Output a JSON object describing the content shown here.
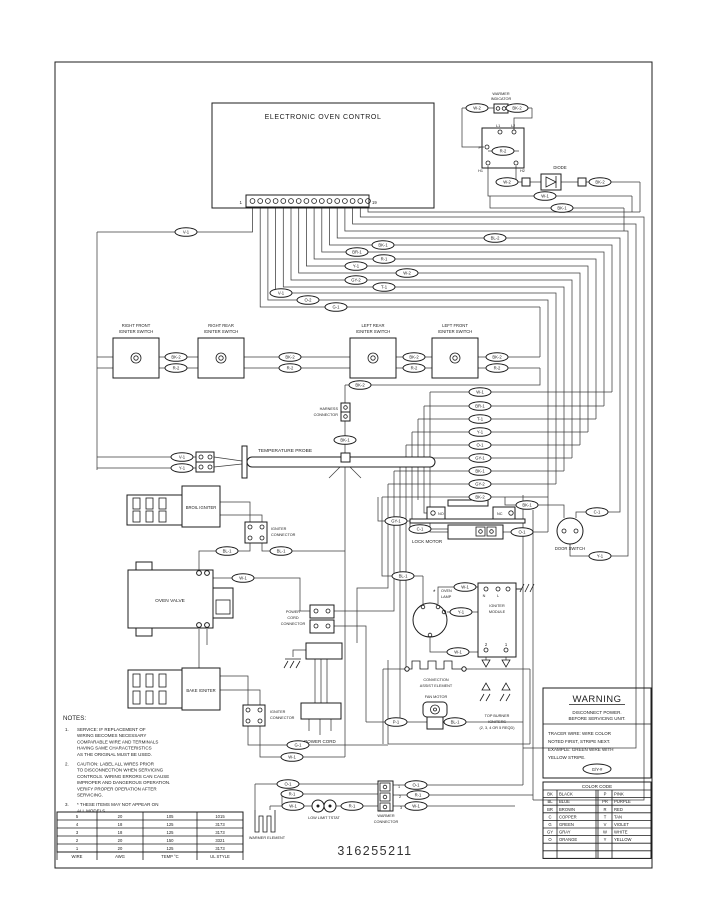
{
  "part_number": "316255211",
  "eoc": {
    "title": "ELECTRONIC OVEN CONTROL",
    "first_terminal": "1",
    "last_terminal": "19"
  },
  "warmer_indicator": {
    "line1": "WARMER",
    "line2": "INDICATOR",
    "relay": {
      "p": "P",
      "l1": "L1",
      "l2": "L2",
      "h1": "H1",
      "h2": "H2"
    },
    "diode": "DIODE"
  },
  "switches": [
    {
      "line1": "RIGHT FRONT",
      "line2": "IGNITER SWITCH"
    },
    {
      "line1": "RIGHT REAR",
      "line2": "IGNITER SWITCH"
    },
    {
      "line1": "LEFT REAR",
      "line2": "IGNITER SWITCH"
    },
    {
      "line1": "LEFT FRONT",
      "line2": "IGNITER SWITCH"
    }
  ],
  "components": {
    "harness_connector1": "HARNESS",
    "harness_connector2": "CONNECTOR",
    "temperature_probe": "TEMPERATURE PROBE",
    "broil_igniter": "BROIL IGNITER",
    "igniter_connector1": "IGNITER",
    "igniter_connector2": "CONNECTOR",
    "oven_valve": "OVEN VALVE",
    "bake_igniter": "BAKE IGNITER",
    "power_cord_connector1": "POWER",
    "power_cord_connector2": "CORD",
    "power_cord_connector3": "CONNECTOR",
    "power_cord": "POWER CORD",
    "lock_motor": "LOCK MOTOR",
    "lock_no": "NO",
    "lock_nc": "NC",
    "door_switch": "DOOR SWITCH",
    "oven_lamp_star": "*",
    "oven_lamp1": "OVEN",
    "oven_lamp2": "LAMP",
    "igniter_module1": "IGNITER",
    "igniter_module2": "MODULE",
    "module_n": "N",
    "module_l": "L",
    "module_2": "2",
    "module_1": "1",
    "convection1": "CONVECTION",
    "convection2": "ASSIST ELEMENT",
    "fan_motor": "FAN MOTOR",
    "top_burner1": "TOP BURNER",
    "top_burner2": "IGNITERS",
    "top_burner3": "(2, 3, 4 OR 5 REQD)",
    "warmer_element": "WARMER ELEMENT",
    "low_limit": "LOW LIMIT TSTAT",
    "warmer_connector1": "WARMER",
    "warmer_connector2": "CONNECTOR",
    "warmer_pins": [
      "1",
      "2",
      "3"
    ]
  },
  "notes": {
    "title": "NOTES:",
    "items": [
      {
        "num": "1.",
        "lines": [
          "SERVICE:  IF REPLACEMENT OF",
          "WIRING BECOMES NECESSARY",
          "COMPARABLE WIRE AND TERMINALS",
          "HAVING SAME CHARACTERISTICS",
          "AS THE ORIGINAL MUST BE USED."
        ]
      },
      {
        "num": "2.",
        "lines": [
          "CAUTION:  LABEL ALL WIRES PRIOR",
          "TO DISCONNECTION WHEN SERVICING",
          "CONTROLS.  WIRING ERRORS CAN CAUSE",
          "IMPROPER AND DANGEROUS OPERATION.",
          "VERIFY PROPER OPERATION AFTER",
          "SERVICING."
        ]
      },
      {
        "num": "3.",
        "lines": [
          "* THESE ITEMS MAY NOT APPEAR ON",
          "ALL MODELS."
        ]
      }
    ]
  },
  "wire_table": {
    "rows": [
      [
        "5",
        "20",
        "105",
        "1015"
      ],
      [
        "4",
        "18",
        "125",
        "3173"
      ],
      [
        "3",
        "18",
        "125",
        "3173"
      ],
      [
        "2",
        "20",
        "150",
        "3321"
      ],
      [
        "1",
        "20",
        "125",
        "3173"
      ]
    ],
    "footer": [
      "WIRE",
      "AWG",
      "TEMP °C",
      "UL STYLE"
    ]
  },
  "warning": {
    "title": "WARNING",
    "lines": [
      "DISCONNECT POWER.",
      "BEFORE SERVICING UNIT."
    ],
    "tracer_lines": [
      "TRACER WIRE:  WIRE COLOR",
      "NOTED FIRST, STRIPE NEXT.",
      "EXAMPLE:  GREEN WIRE WITH",
      "YELLOW STRIPE."
    ],
    "example_label": "G/Y-#"
  },
  "color_code": {
    "title": "COLOR CODE",
    "rows": [
      [
        "BK",
        "BLACK",
        "P",
        "PINK"
      ],
      [
        "BL",
        "BLUE",
        "PR",
        "PURPLE"
      ],
      [
        "BR",
        "BROWN",
        "R",
        "RED"
      ],
      [
        "C",
        "COPPER",
        "T",
        "TAN"
      ],
      [
        "G",
        "GREEN",
        "V",
        "VIOLET"
      ],
      [
        "GY",
        "GRAY",
        "W",
        "WHITE"
      ],
      [
        "O",
        "ORANGE",
        "Y",
        "YELLOW"
      ]
    ],
    "empty_rows": 2
  },
  "wire_labels": [
    [
      477,
      108,
      "W-2"
    ],
    [
      517,
      108,
      "BK-2"
    ],
    [
      503,
      151,
      "R-2"
    ],
    [
      507,
      182,
      "W-2"
    ],
    [
      600,
      182,
      "BK-2"
    ],
    [
      545,
      196,
      "W-1"
    ],
    [
      562,
      208,
      "BK-1"
    ],
    [
      186,
      232,
      "V-1"
    ],
    [
      336,
      307,
      "G-1"
    ],
    [
      308,
      300,
      "O-2"
    ],
    [
      281,
      293,
      "V-1"
    ],
    [
      384,
      287,
      "T-1"
    ],
    [
      356,
      280,
      "GY-2"
    ],
    [
      407,
      273,
      "W-2"
    ],
    [
      356,
      266,
      "Y-1"
    ],
    [
      384,
      259,
      "R-1"
    ],
    [
      357,
      252,
      "BR-1"
    ],
    [
      383,
      245,
      "BK-1"
    ],
    [
      495,
      238,
      "BL-2"
    ],
    [
      176,
      357,
      "BK-2"
    ],
    [
      176,
      368,
      "R-2"
    ],
    [
      290,
      357,
      "BK-2"
    ],
    [
      290,
      368,
      "R-2"
    ],
    [
      414,
      357,
      "BK-2"
    ],
    [
      414,
      368,
      "R-2"
    ],
    [
      497,
      357,
      "BK-2"
    ],
    [
      497,
      368,
      "R-2"
    ],
    [
      360,
      385,
      "BK-2"
    ],
    [
      182,
      457,
      "V-1"
    ],
    [
      182,
      468,
      "Y-1"
    ],
    [
      345,
      440,
      "BK-1"
    ],
    [
      227,
      551,
      "BL-1"
    ],
    [
      281,
      551,
      "BL-1"
    ],
    [
      243,
      578,
      "W-1"
    ],
    [
      480,
      392,
      "W-1"
    ],
    [
      480,
      406,
      "BR-1"
    ],
    [
      480,
      419,
      "T-1"
    ],
    [
      480,
      432,
      "Y-1"
    ],
    [
      480,
      445,
      "O-1"
    ],
    [
      480,
      458,
      "GY-1"
    ],
    [
      480,
      471,
      "BK-1"
    ],
    [
      480,
      484,
      "GY-2"
    ],
    [
      480,
      497,
      "BK-2"
    ],
    [
      396,
      521,
      "GY-1"
    ],
    [
      420,
      529,
      "C-1"
    ],
    [
      522,
      532,
      "O-1"
    ],
    [
      527,
      505,
      "BK-1"
    ],
    [
      597,
      512,
      "C-1"
    ],
    [
      600,
      556,
      "Y-1"
    ],
    [
      403,
      576,
      "BL-1"
    ],
    [
      465,
      587,
      "W-1"
    ],
    [
      461,
      612,
      "Y-1"
    ],
    [
      458,
      652,
      "W-1"
    ],
    [
      396,
      722,
      "P-1"
    ],
    [
      455,
      722,
      "BL-1"
    ],
    [
      298,
      745,
      "G-1"
    ],
    [
      292,
      757,
      "W-1"
    ],
    [
      288,
      784,
      "O-1"
    ],
    [
      292,
      794,
      "R-1"
    ],
    [
      293,
      806,
      "W-1"
    ],
    [
      352,
      806,
      "R-1"
    ],
    [
      416,
      785,
      "O-1"
    ],
    [
      418,
      795,
      "R-1"
    ],
    [
      416,
      806,
      "W-1"
    ]
  ]
}
